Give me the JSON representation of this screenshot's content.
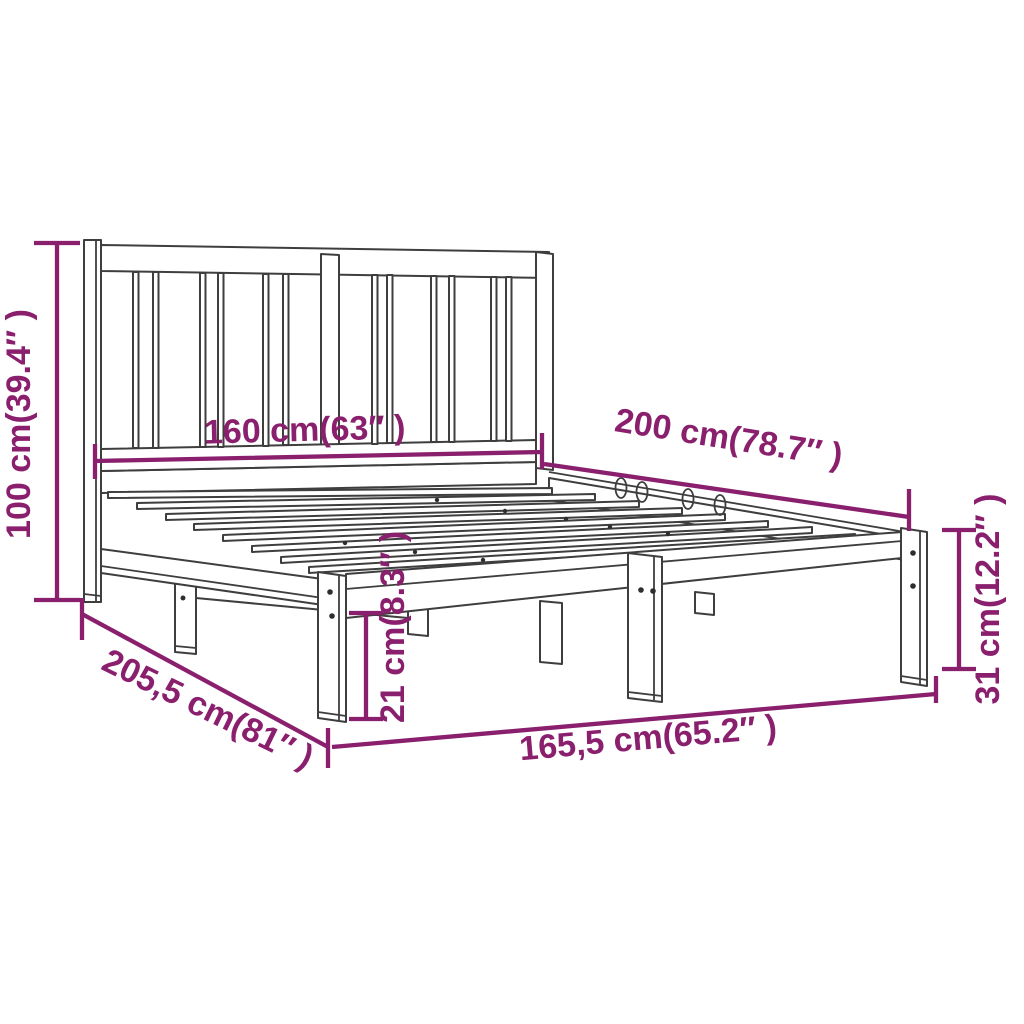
{
  "diagram": {
    "type": "product dimension drawing",
    "subject": "wooden bed frame with slatted headboard",
    "background_color": "#FFFFFF",
    "drawing_line_color": "#3E3E3E",
    "dimension_color": "#8A1F6D",
    "labels": {
      "headboard_height": "100 cm(39.4″ )",
      "headboard_width": "160 cm(63″ )",
      "bed_length": "200 cm(78.7″ )",
      "frame_side_height": "31 cm(12.2″ )",
      "under_frame_clearance": "21 cm(8.3″ )",
      "total_length": "205,5 cm(81″ )",
      "total_width": "165,5 cm(65.2″ )"
    }
  }
}
